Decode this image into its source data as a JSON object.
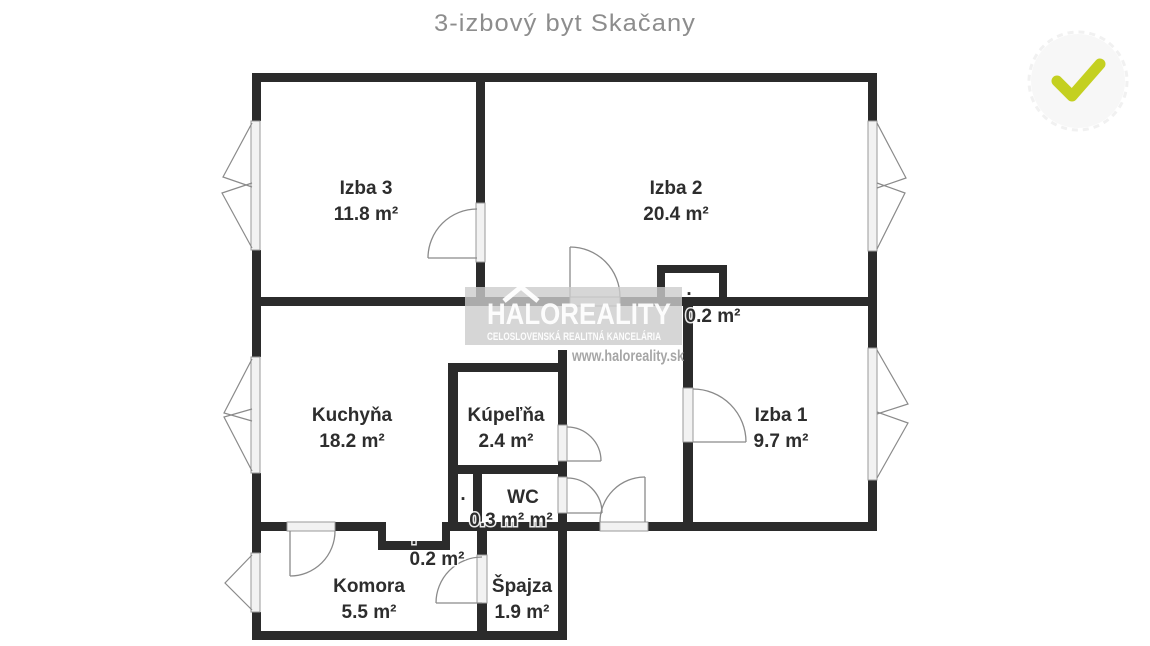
{
  "page_title": "3-izbový byt Skačany",
  "floorplan": {
    "rooms": {
      "izba3": {
        "name": "Izba 3",
        "area": "11.8 m²"
      },
      "izba2": {
        "name": "Izba 2",
        "area": "20.4 m²"
      },
      "izba1": {
        "name": "Izba 1",
        "area": "9.7 m²"
      },
      "kuchyna": {
        "name": "Kuchyňa",
        "area": "18.2 m²"
      },
      "kupelna": {
        "name": "Kúpeľňa",
        "area": "2.4 m²"
      },
      "wc": {
        "name": "WC",
        "area": "0.3 m² m²"
      },
      "komora": {
        "name": "Komora",
        "area": "5.5 m²"
      },
      "spajza": {
        "name": "Špajza",
        "area": "1.9 m²"
      }
    },
    "annotations": {
      "niche_top_area": "0.2 m²",
      "niche_bottom_area": "0.2 m²",
      "shaft_dot": ".",
      "niche_top_dot": ".",
      "niche_bottom_dot": "."
    }
  },
  "watermark": {
    "brand": "HALOREALITY",
    "subtitle": "CELOSLOVENSKÁ REALITNÁ KANCELÁRIA",
    "website": "www.haloreality.sk",
    "logo_icon": "roof-chevron"
  },
  "badge": {
    "icon": "checkmark"
  },
  "colors": {
    "wall": "#2b2b2b",
    "label_text": "#2d2d2d",
    "title_text": "#8d8d8d",
    "door_window_lines": "#8a8a8a",
    "watermark_box": "#cccccc",
    "badge_check": "#c4d021",
    "badge_circle": "#f7f7f7"
  }
}
